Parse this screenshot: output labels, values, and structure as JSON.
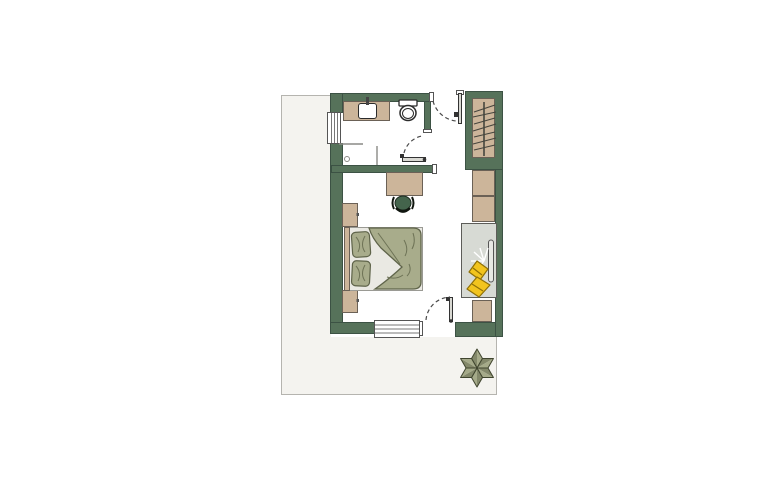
{
  "meta": {
    "type": "floor-plan",
    "description": "Top-down architectural floor plan of a hotel guest room with en-suite bathroom, entry, wardrobe, bedroom and terrace. No visible text labels in the drawing."
  },
  "colors": {
    "wall": "#56725a",
    "wall_edge": "#3c5244",
    "terrace_fill": "#f4f3ef",
    "terrace_edge": "#b5b4af",
    "floor": "#ffffff",
    "furniture_tan": "#ccb59a",
    "furniture_edge": "#6b6156",
    "bedding_sage": "#a8ac8b",
    "bedding_edge": "#5f644a",
    "bedding_crease": "#6e7356",
    "sheet": "#eae9e3",
    "sheet_edge": "#9a9a94",
    "chair_green": "#44644c",
    "daybed_gray": "#d7dad4",
    "daybed_edge": "#5c5c58",
    "accent_yellow": "#f2c41e",
    "accent_yellow_edge": "#8f7007",
    "star_light": "#a5aa89",
    "star_dark": "#83886a",
    "star_edge": "#40452f",
    "fixture_white": "#ffffff",
    "outline_dark": "#2b2b2b",
    "dash_color": "#4a4a4a",
    "glass_line": "#8a8a85",
    "leaf_fill": "#d9d9d3",
    "window_line": "#777777"
  },
  "areas": [
    {
      "name": "terrace",
      "note": "light gray bordered ground area around lower-left of plan, decorative star flower at bottom right"
    },
    {
      "name": "bathroom",
      "fixtures": [
        "vanity-with-sink",
        "toilet",
        "shower-with-drain",
        "wall-window"
      ]
    },
    {
      "name": "entry-corridor",
      "fixtures": [
        "entry-door-with-swing-arc",
        "bathroom-door-with-swing-arc"
      ]
    },
    {
      "name": "wardrobe",
      "fixtures": [
        "hanging-rod",
        "seven-hangers",
        "two-cabinet-shelves"
      ]
    },
    {
      "name": "bedroom",
      "fixtures": [
        "double-bed-with-duvet-and-two-pillows",
        "headboard",
        "two-nightstands",
        "desk",
        "desk-chair",
        "daybed-with-tv-and-sparkle",
        "two-yellow-cushions",
        "lower-cabinet",
        "balcony-window",
        "balcony-door-with-swing-arc"
      ]
    }
  ],
  "decorations": [
    {
      "name": "star-flower",
      "petals": 6
    },
    {
      "name": "sparkle",
      "rays": 5
    }
  ]
}
